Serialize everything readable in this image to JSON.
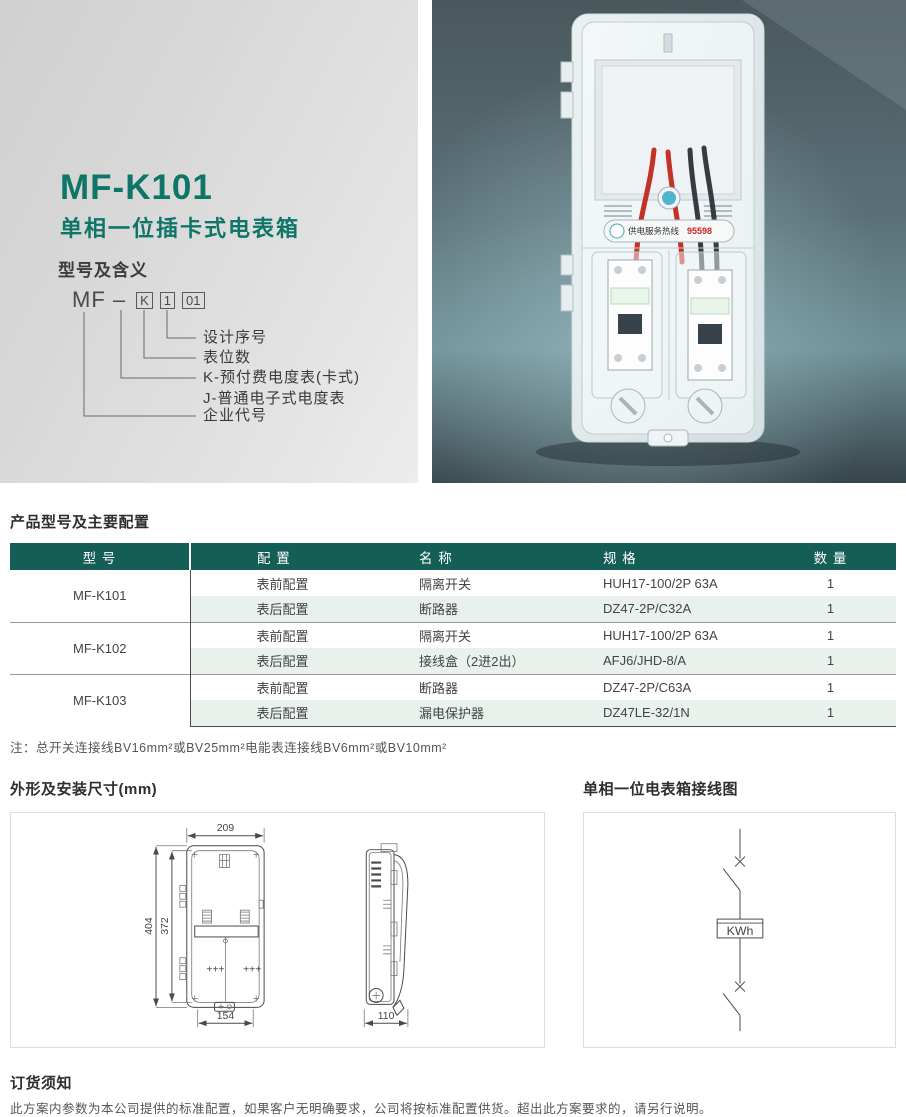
{
  "intro": {
    "model": "MF-K101",
    "subtitle": "单相一位插卡式电表箱",
    "section_title": "型号及含义",
    "code_prefix": "MF –",
    "code_boxes": [
      "K",
      "1",
      "01"
    ],
    "code_labels": [
      "设计序号",
      "表位数",
      "K-预付费电度表(卡式)",
      "J-普通电子式电度表",
      "企业代号"
    ]
  },
  "photo": {
    "hotline_label": "供电服务热线",
    "hotline_number": "95598"
  },
  "config_table": {
    "title": "产品型号及主要配置",
    "headers": [
      "型 号",
      "配 置",
      "名 称",
      "规 格",
      "数 量"
    ],
    "groups": [
      {
        "model": "MF-K101",
        "rows": [
          {
            "config": "表前配置",
            "name": "隔离开关",
            "spec": "HUH17-100/2P 63A",
            "qty": "1"
          },
          {
            "config": "表后配置",
            "name": "断路器",
            "spec": "DZ47-2P/C32A",
            "qty": "1"
          }
        ]
      },
      {
        "model": "MF-K102",
        "rows": [
          {
            "config": "表前配置",
            "name": "隔离开关",
            "spec": "HUH17-100/2P 63A",
            "qty": "1"
          },
          {
            "config": "表后配置",
            "name": "接线盒（2进2出）",
            "spec": "AFJ6/JHD-8/A",
            "qty": "1"
          }
        ]
      },
      {
        "model": "MF-K103",
        "rows": [
          {
            "config": "表前配置",
            "name": "断路器",
            "spec": "DZ47-2P/C63A",
            "qty": "1"
          },
          {
            "config": "表后配置",
            "name": "漏电保护器",
            "spec": "DZ47LE-32/1N",
            "qty": "1"
          }
        ]
      }
    ],
    "note": "注：总开关连接线BV16mm²或BV25mm²电能表连接线BV6mm²或BV10mm²"
  },
  "dimensions": {
    "title": "外形及安装尺寸(mm)",
    "top_width": "209",
    "overall_height": "404",
    "inner_height": "372",
    "bottom_width": "154",
    "depth": "110"
  },
  "wiring": {
    "title": "单相一位电表箱接线图",
    "meter_label": "KWh"
  },
  "ordering": {
    "title": "订货须知",
    "note": "此方案内参数为本公司提供的标准配置，如果客户无明确要求，公司将按标准配置供货。超出此方案要求的，请另行说明。"
  },
  "colors": {
    "accent_teal": "#0e7568",
    "table_header_bg": "#145e56",
    "row_alt_bg": "#e8f1ec",
    "hotline_red": "#cc2222"
  }
}
